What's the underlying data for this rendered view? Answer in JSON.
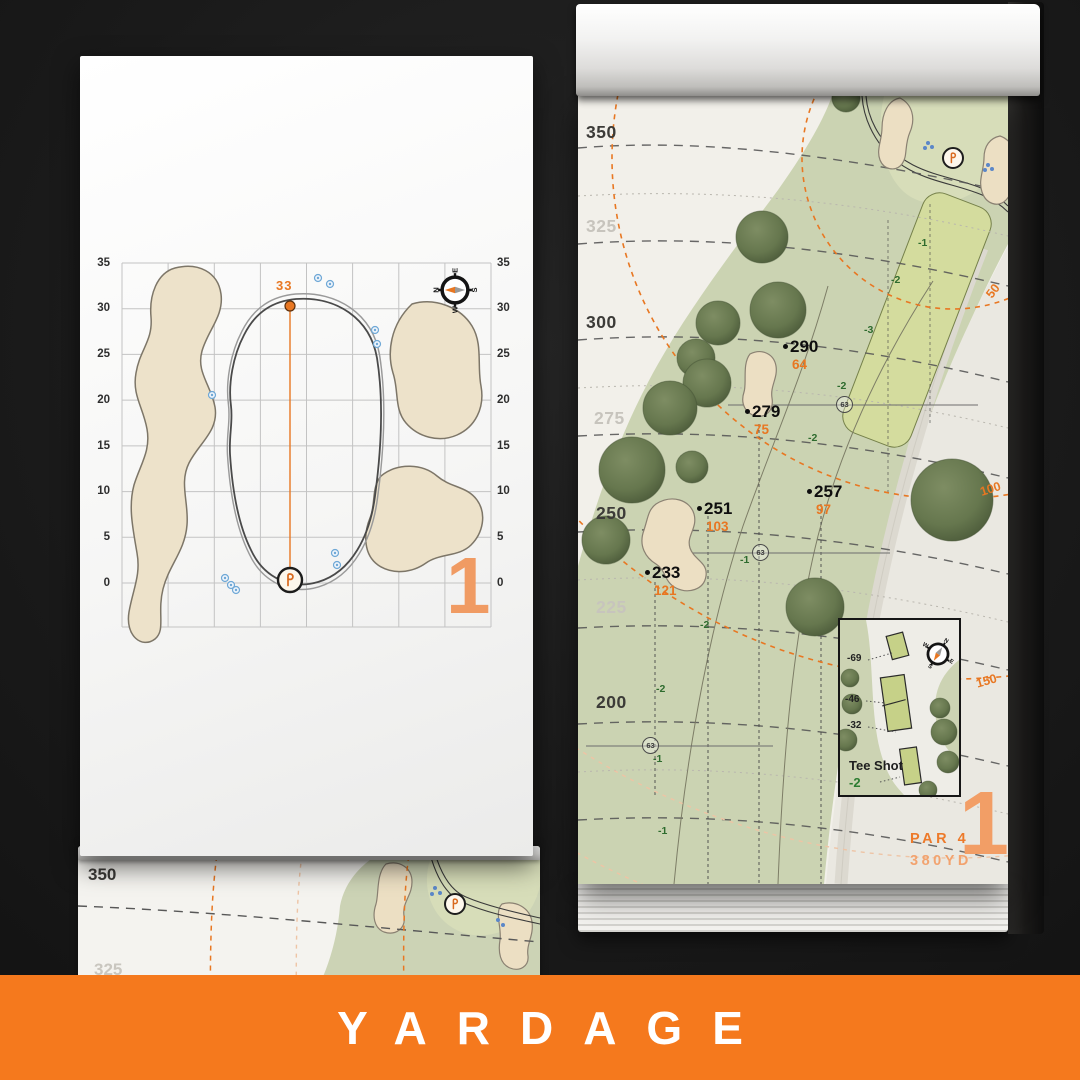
{
  "banner": {
    "title": "YARDAGE"
  },
  "colors": {
    "accent_orange": "#E87722",
    "banner_orange": "#F5791D",
    "hole_number_orange": "#F09B63",
    "slope_green": "#2E6B2E",
    "sprinkler_blue": "#5B87C8",
    "sand": "#ECDFC3",
    "fairway_green": "#CBD3B2"
  },
  "compass": {
    "n": "N",
    "e": "E",
    "s": "S",
    "w": "W"
  },
  "green_page": {
    "hole_number": "1",
    "front_pin_distance": "33",
    "axis_labels": [
      "35",
      "30",
      "25",
      "20",
      "15",
      "10",
      "5",
      "0"
    ]
  },
  "hole_page": {
    "hole_number": "1",
    "par": "PAR 4",
    "yardage": "380YD",
    "side_yardages": [
      {
        "label": "350",
        "muted": false
      },
      {
        "label": "325",
        "muted": true
      },
      {
        "label": "300",
        "muted": false
      },
      {
        "label": "275",
        "muted": true
      },
      {
        "label": "250",
        "muted": false
      },
      {
        "label": "225",
        "muted": true
      },
      {
        "label": "200",
        "muted": false
      }
    ],
    "arc_labels": [
      "50",
      "100",
      "150"
    ],
    "markers": [
      {
        "carry": "290",
        "to_pin": "64"
      },
      {
        "carry": "279",
        "to_pin": "75"
      },
      {
        "carry": "257",
        "to_pin": "97"
      },
      {
        "carry": "251",
        "to_pin": "103"
      },
      {
        "carry": "233",
        "to_pin": "121"
      }
    ],
    "sprinkler_number": "63",
    "slope_labels": [
      "-1",
      "-2",
      "-3",
      "-2",
      "-2",
      "-1",
      "-2",
      "-2",
      "-1",
      "-1"
    ],
    "tee_box": {
      "title": "Tee Shot",
      "slope": "-2",
      "distances": [
        "-69",
        "-46",
        "-32"
      ]
    }
  },
  "under_page": {
    "labels": [
      "350",
      "325"
    ]
  }
}
